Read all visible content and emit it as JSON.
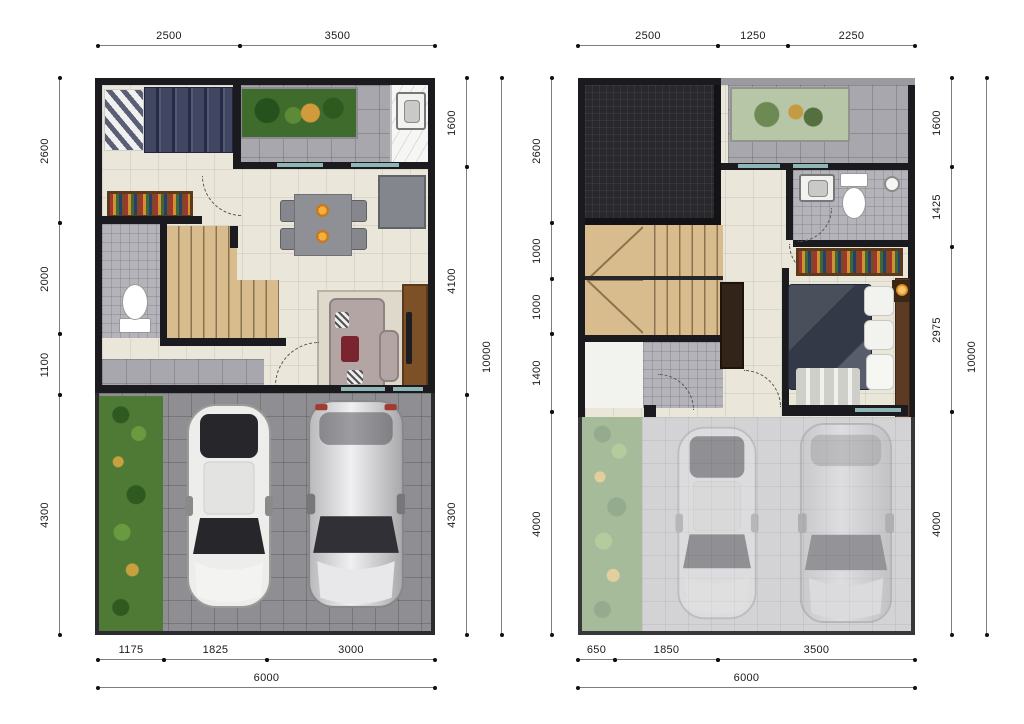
{
  "floorplan": {
    "left_plan": {
      "dims_top": [
        "2500",
        "3500"
      ],
      "dims_bottom": [
        "1175",
        "1825",
        "3000"
      ],
      "dims_bottom_total": "6000",
      "dims_left": [
        "2600",
        "2000",
        "1100",
        "4300"
      ],
      "dims_right": [
        "1600",
        "4100",
        "4300"
      ],
      "dims_right_total": "10000"
    },
    "right_plan": {
      "dims_top": [
        "2500",
        "1250",
        "2250"
      ],
      "dims_bottom": [
        "650",
        "1850",
        "3500"
      ],
      "dims_bottom_total": "6000",
      "dims_left": [
        "2600",
        "1000",
        "1000",
        "1400",
        "4000"
      ],
      "dims_right": [
        "1600",
        "1425",
        "2975",
        "4000"
      ],
      "dims_right_total": "10000"
    }
  },
  "colors": {
    "wall": "#1b1b1f",
    "interior_floor": "#eae6da",
    "terrace_tile": "#a7a7ad",
    "bath_tile": "#b3b3b9",
    "carport_paving": "#8f8f93",
    "grass": "#4e7a35",
    "stairs_wood": "#d9bc8e",
    "roof_dark": "#28282d",
    "glass_accent": "#8fb6b6",
    "dimension_text": "#1a1a1a"
  }
}
